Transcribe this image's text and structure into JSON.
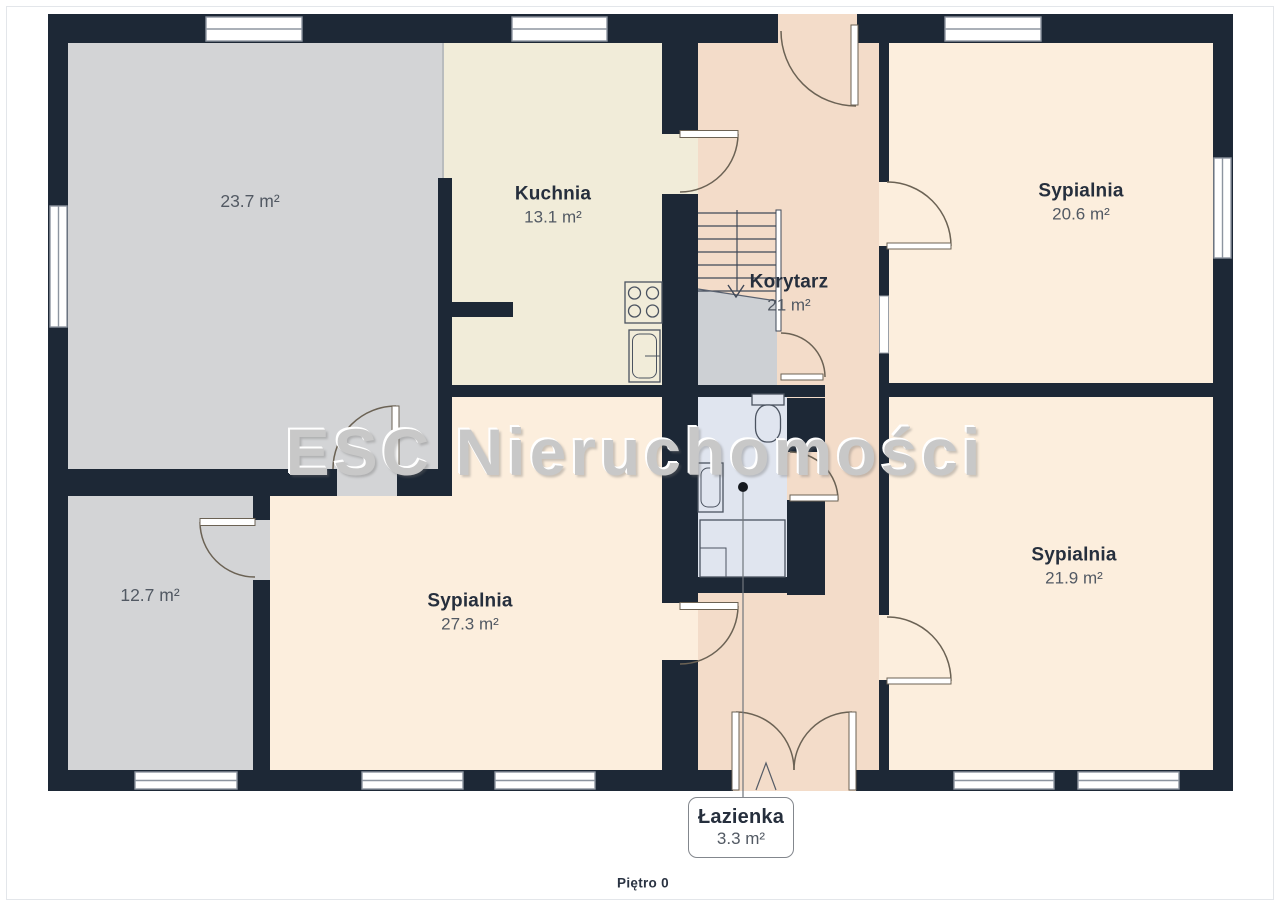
{
  "page": {
    "watermark": "ESC Nieruchomości",
    "floor_label": "Piętro 0"
  },
  "rooms": [
    {
      "key": "living-gray",
      "area": "23.7 m²"
    },
    {
      "key": "kitchen",
      "name": "Kuchnia",
      "area": "13.1 m²"
    },
    {
      "key": "corridor",
      "name": "Korytarz",
      "area": "21 m²"
    },
    {
      "key": "bedroom-top-right",
      "name": "Sypialnia",
      "area": "20.6 m²"
    },
    {
      "key": "room-gray-small",
      "area": "12.7 m²"
    },
    {
      "key": "bedroom-left",
      "name": "Sypialnia",
      "area": "27.3 m²"
    },
    {
      "key": "bedroom-bottom-right",
      "name": "Sypialnia",
      "area": "21.9 m²"
    },
    {
      "key": "bathroom",
      "name": "Łazienka",
      "area": "3.3 m²"
    }
  ],
  "fixtures": [
    "stove-icon",
    "kitchen-sink-icon",
    "toilet-icon",
    "washbasin-icon",
    "shower-icon",
    "staircase-down-icon",
    "door-arc-icon",
    "window-icon"
  ],
  "colors": {
    "wall": "#1d2836",
    "gray_room": "#d3d4d6",
    "kitchen_cream": "#f1ecd9",
    "corridor_pink": "#f3dcc9",
    "bedroom_peach": "#fceedd",
    "bathroom_blue": "#e0e5ef",
    "understairs_gray": "#cdd0d4",
    "watermark_gray": "#c8c8c8",
    "label_navy": "#262f3d"
  }
}
